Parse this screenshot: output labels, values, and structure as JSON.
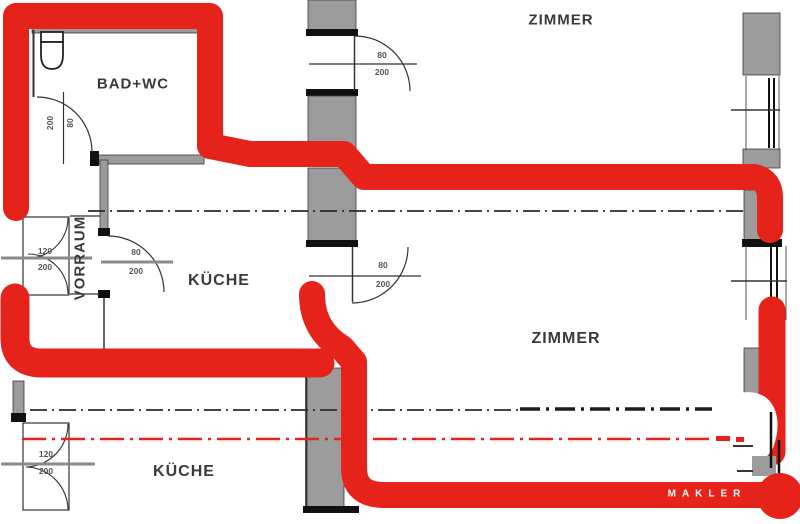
{
  "rooms": {
    "bad_wc": "BAD+WC",
    "vorraum": "VORRAUM",
    "kueche": "KÜCHE",
    "zimmer_top": "ZIMMER",
    "zimmer_right": "ZIMMER",
    "kueche_bottom": "KÜCHE"
  },
  "doors": {
    "bad_wc": {
      "width": "80",
      "height": "200"
    },
    "entrance": {
      "width": "120",
      "height": "200"
    },
    "kueche": {
      "width": "80",
      "height": "200"
    },
    "zimmer_top": {
      "width": "80",
      "height": "200"
    },
    "zimmer_mid": {
      "width": "80",
      "height": "200"
    },
    "kueche_bottom": {
      "width": "120",
      "height": "200"
    }
  },
  "branding": {
    "label": "MAKLER"
  },
  "colors": {
    "marker_red": "#e5231b",
    "centerline_red": "#e5231b",
    "wall_gray": "#9c9c9c",
    "line_dark": "#2b2b2b",
    "watermark_text": "#ffffff"
  }
}
